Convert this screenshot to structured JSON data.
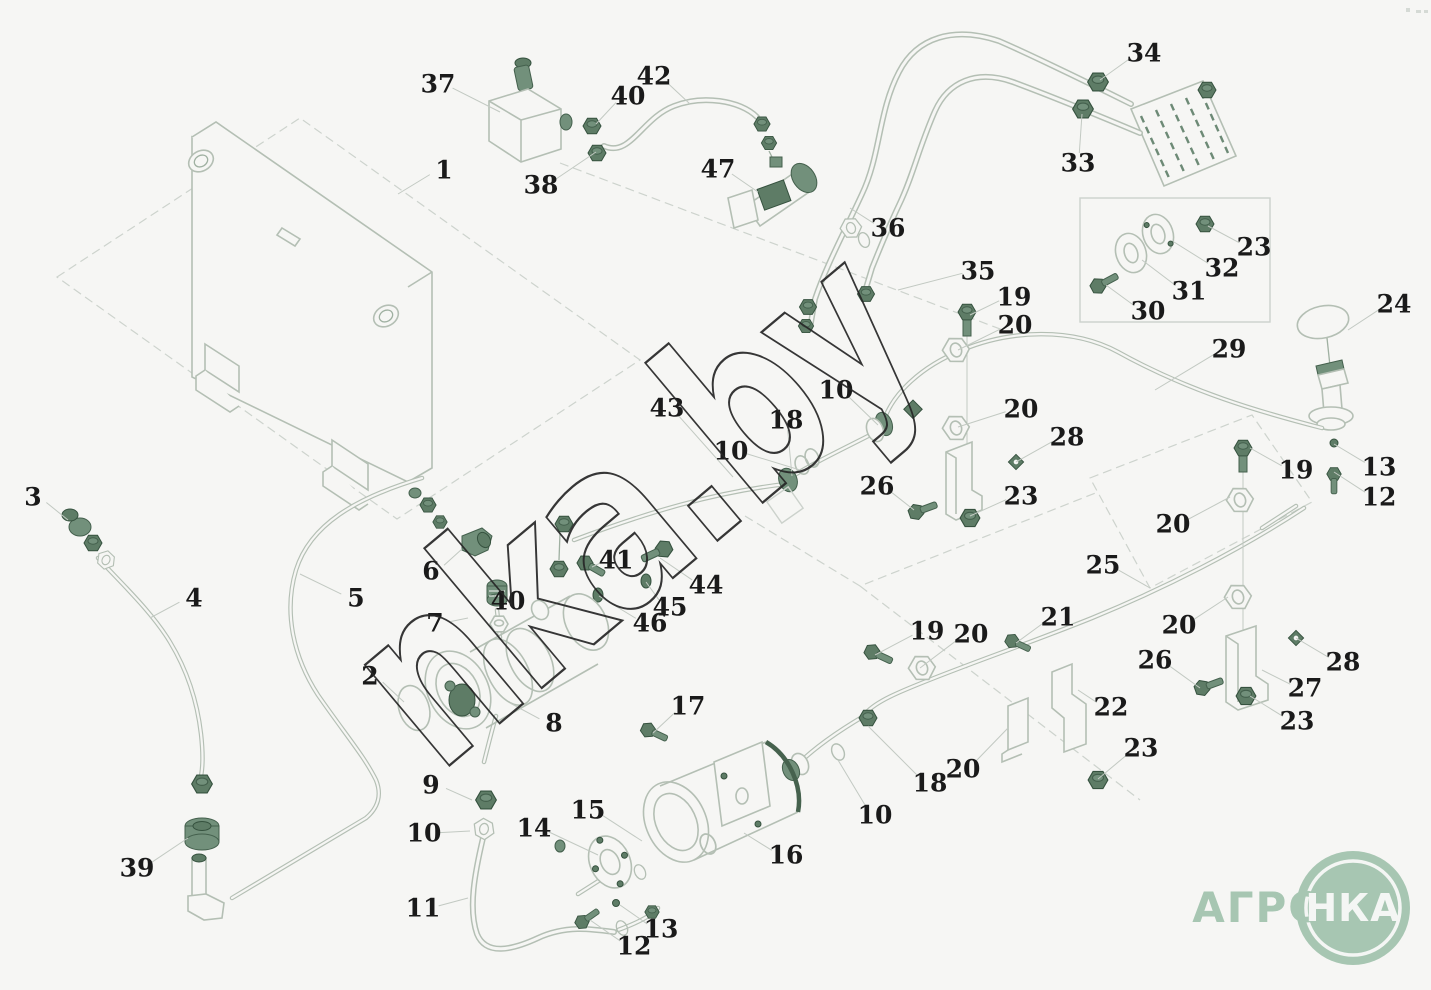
{
  "watermark_text": "nka.by",
  "logo": {
    "prefix": "АГРО",
    "circle": "НКА",
    "color": "#a7c6b2"
  },
  "colors": {
    "background": "#f6f6f4",
    "outline": "#b4bfb4",
    "hardware": "#5e7c66",
    "label": "#1a1a1a",
    "leader": "#c2c9c2",
    "logo_green": "#a7c6b2"
  },
  "labels": [
    {
      "t": "37",
      "x": 438,
      "y": 84,
      "tx": 500,
      "ty": 112
    },
    {
      "t": "40",
      "x": 628,
      "y": 96,
      "tx": 596,
      "ty": 124
    },
    {
      "t": "42",
      "x": 654,
      "y": 76,
      "tx": 690,
      "ty": 104
    },
    {
      "t": "1",
      "x": 444,
      "y": 170,
      "tx": 398,
      "ty": 194
    },
    {
      "t": "38",
      "x": 541,
      "y": 185,
      "tx": 596,
      "ty": 152
    },
    {
      "t": "47",
      "x": 718,
      "y": 169,
      "tx": 758,
      "ty": 192
    },
    {
      "t": "34",
      "x": 1144,
      "y": 53,
      "tx": 1100,
      "ty": 80
    },
    {
      "t": "33",
      "x": 1078,
      "y": 163,
      "tx": 1082,
      "ty": 114
    },
    {
      "t": "36",
      "x": 888,
      "y": 228,
      "tx": 850,
      "ty": 208
    },
    {
      "t": "35",
      "x": 978,
      "y": 271,
      "tx": 898,
      "ty": 290
    },
    {
      "t": "23",
      "x": 1254,
      "y": 247,
      "tx": 1208,
      "ty": 226
    },
    {
      "t": "32",
      "x": 1222,
      "y": 268,
      "tx": 1174,
      "ty": 242
    },
    {
      "t": "31",
      "x": 1189,
      "y": 291,
      "tx": 1142,
      "ty": 260
    },
    {
      "t": "30",
      "x": 1148,
      "y": 311,
      "tx": 1106,
      "ty": 285
    },
    {
      "t": "29",
      "x": 1229,
      "y": 349,
      "tx": 1155,
      "ty": 390
    },
    {
      "t": "24",
      "x": 1394,
      "y": 304,
      "tx": 1348,
      "ty": 330
    },
    {
      "t": "19",
      "x": 1014,
      "y": 297,
      "tx": 970,
      "ty": 315
    },
    {
      "t": "20",
      "x": 1015,
      "y": 325,
      "tx": 958,
      "ty": 350
    },
    {
      "t": "10",
      "x": 836,
      "y": 390,
      "tx": 878,
      "ty": 425
    },
    {
      "t": "18",
      "x": 786,
      "y": 420,
      "tx": 792,
      "ty": 476
    },
    {
      "t": "10",
      "x": 731,
      "y": 451,
      "tx": 800,
      "ty": 470
    },
    {
      "t": "43",
      "x": 667,
      "y": 408,
      "tx": 733,
      "ty": 477
    },
    {
      "t": "20",
      "x": 1021,
      "y": 409,
      "tx": 958,
      "ty": 427
    },
    {
      "t": "28",
      "x": 1067,
      "y": 437,
      "tx": 1016,
      "ty": 462
    },
    {
      "t": "26",
      "x": 877,
      "y": 486,
      "tx": 914,
      "ty": 510
    },
    {
      "t": "23",
      "x": 1021,
      "y": 496,
      "tx": 970,
      "ty": 516
    },
    {
      "t": "19",
      "x": 1296,
      "y": 470,
      "tx": 1250,
      "ty": 448
    },
    {
      "t": "13",
      "x": 1379,
      "y": 467,
      "tx": 1334,
      "ty": 444
    },
    {
      "t": "12",
      "x": 1379,
      "y": 497,
      "tx": 1334,
      "ty": 472
    },
    {
      "t": "20",
      "x": 1173,
      "y": 524,
      "tx": 1230,
      "ty": 497
    },
    {
      "t": "25",
      "x": 1103,
      "y": 565,
      "tx": 1150,
      "ty": 588
    },
    {
      "t": "20",
      "x": 1179,
      "y": 625,
      "tx": 1228,
      "ty": 597
    },
    {
      "t": "26",
      "x": 1155,
      "y": 660,
      "tx": 1200,
      "ty": 688
    },
    {
      "t": "28",
      "x": 1343,
      "y": 662,
      "tx": 1296,
      "ty": 638
    },
    {
      "t": "27",
      "x": 1305,
      "y": 688,
      "tx": 1262,
      "ty": 670
    },
    {
      "t": "23",
      "x": 1297,
      "y": 721,
      "tx": 1250,
      "ty": 696
    },
    {
      "t": "21",
      "x": 1058,
      "y": 617,
      "tx": 1016,
      "ty": 643
    },
    {
      "t": "22",
      "x": 1111,
      "y": 707,
      "tx": 1078,
      "ty": 690
    },
    {
      "t": "23",
      "x": 1141,
      "y": 748,
      "tx": 1098,
      "ty": 779
    },
    {
      "t": "20",
      "x": 963,
      "y": 769,
      "tx": 1008,
      "ty": 728
    },
    {
      "t": "18",
      "x": 930,
      "y": 783,
      "tx": 868,
      "ty": 726
    },
    {
      "t": "10",
      "x": 875,
      "y": 815,
      "tx": 838,
      "ty": 760
    },
    {
      "t": "16",
      "x": 786,
      "y": 855,
      "tx": 744,
      "ty": 833
    },
    {
      "t": "15",
      "x": 588,
      "y": 810,
      "tx": 642,
      "ty": 841
    },
    {
      "t": "14",
      "x": 534,
      "y": 828,
      "tx": 598,
      "ty": 855
    },
    {
      "t": "9",
      "x": 431,
      "y": 785,
      "tx": 472,
      "ty": 800
    },
    {
      "t": "10",
      "x": 424,
      "y": 833,
      "tx": 470,
      "ty": 831
    },
    {
      "t": "11",
      "x": 423,
      "y": 908,
      "tx": 468,
      "ty": 898
    },
    {
      "t": "13",
      "x": 661,
      "y": 929,
      "tx": 620,
      "ty": 905
    },
    {
      "t": "12",
      "x": 634,
      "y": 946,
      "tx": 590,
      "ty": 920
    },
    {
      "t": "17",
      "x": 688,
      "y": 706,
      "tx": 653,
      "ty": 733
    },
    {
      "t": "8",
      "x": 554,
      "y": 723,
      "tx": 510,
      "ty": 703
    },
    {
      "t": "2",
      "x": 370,
      "y": 676,
      "tx": 404,
      "ty": 702
    },
    {
      "t": "6",
      "x": 431,
      "y": 571,
      "tx": 462,
      "ty": 549
    },
    {
      "t": "40",
      "x": 508,
      "y": 601,
      "tx": 497,
      "ty": 595
    },
    {
      "t": "7",
      "x": 435,
      "y": 623,
      "tx": 468,
      "ty": 618
    },
    {
      "t": "41",
      "x": 616,
      "y": 560,
      "tx": 592,
      "ty": 567
    },
    {
      "t": "44",
      "x": 706,
      "y": 585,
      "tx": 660,
      "ty": 558
    },
    {
      "t": "45",
      "x": 670,
      "y": 607,
      "tx": 646,
      "ty": 582
    },
    {
      "t": "46",
      "x": 650,
      "y": 623,
      "tx": 599,
      "ty": 596
    },
    {
      "t": "3",
      "x": 33,
      "y": 497,
      "tx": 68,
      "ty": 520
    },
    {
      "t": "4",
      "x": 194,
      "y": 598,
      "tx": 150,
      "ty": 618
    },
    {
      "t": "5",
      "x": 356,
      "y": 598,
      "tx": 300,
      "ty": 574
    },
    {
      "t": "39",
      "x": 137,
      "y": 868,
      "tx": 188,
      "ty": 838
    },
    {
      "t": "19",
      "x": 927,
      "y": 631,
      "tx": 875,
      "ty": 655
    },
    {
      "t": "20",
      "x": 971,
      "y": 634,
      "tx": 920,
      "ty": 668
    }
  ]
}
